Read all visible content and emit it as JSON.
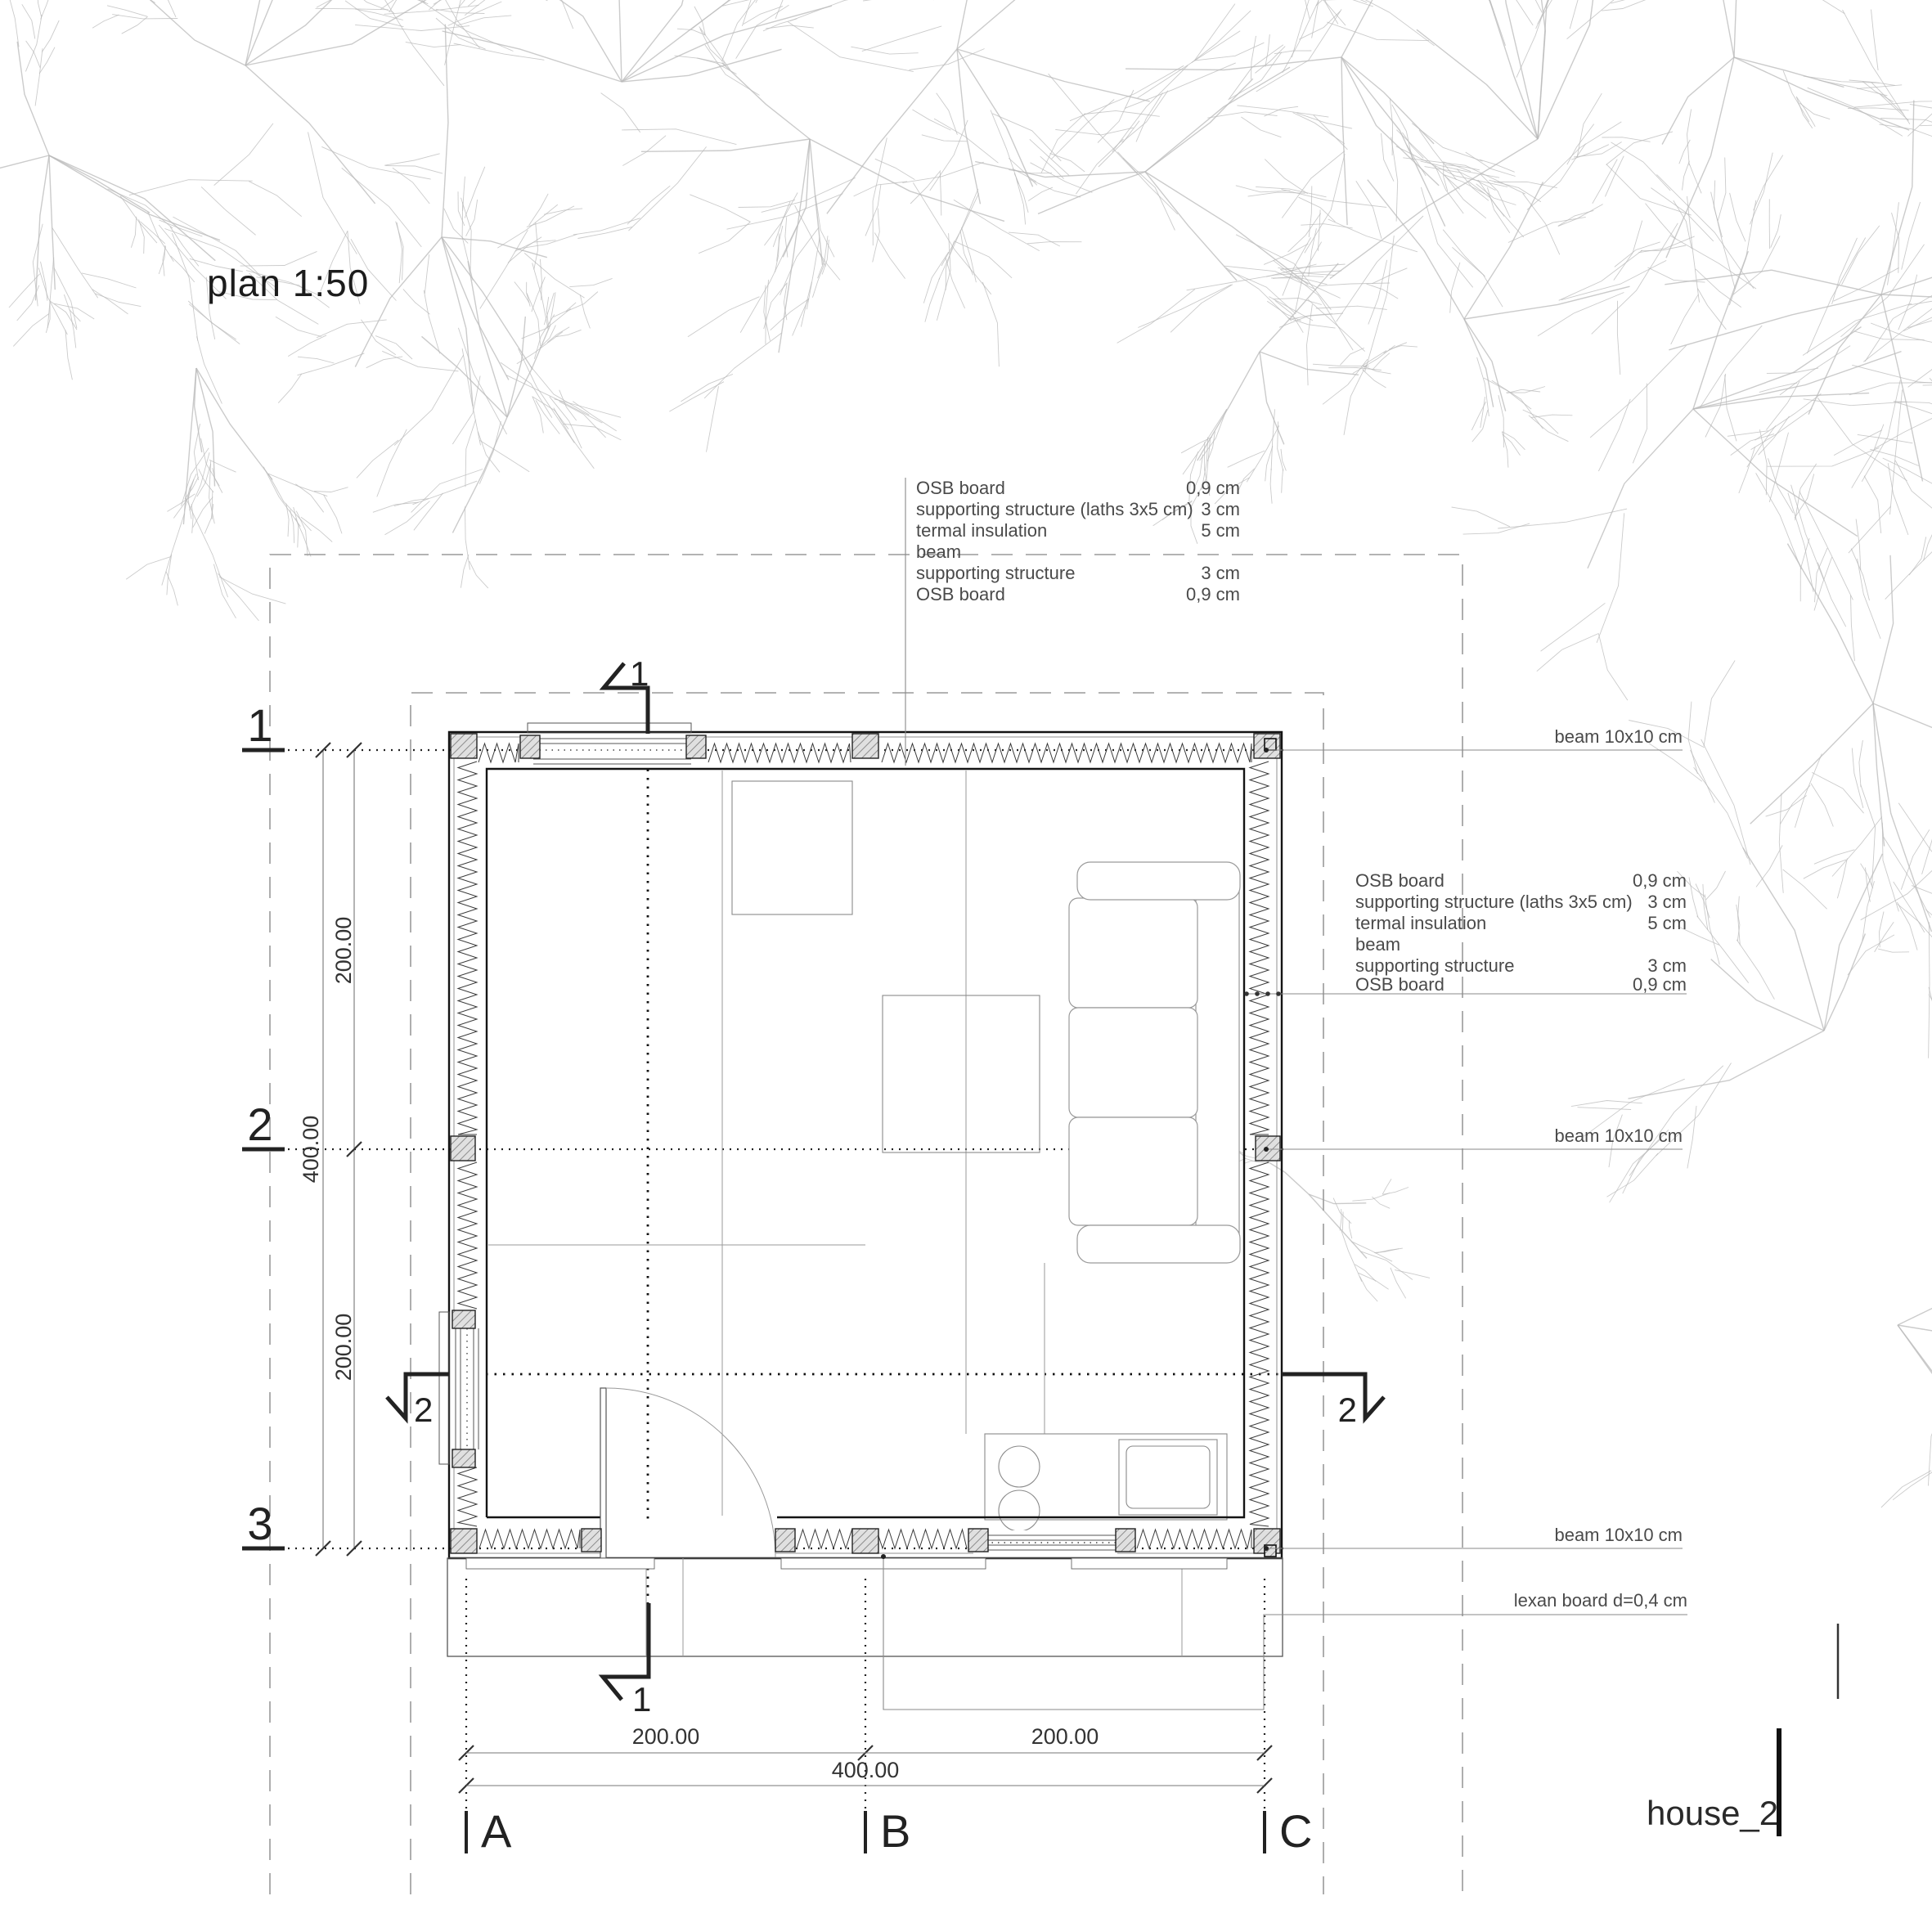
{
  "title": "plan 1:50",
  "sheet": {
    "label": "house_2"
  },
  "wall_layers_top": {
    "rows": [
      {
        "label": "OSB board",
        "value": "0,9 cm"
      },
      {
        "label": "supporting structure  (laths 3x5 cm)",
        "value": "3 cm"
      },
      {
        "label": "termal insulation",
        "value": "5 cm"
      },
      {
        "label": "beam",
        "value": ""
      },
      {
        "label": "supporting structure",
        "value": "3 cm"
      },
      {
        "label": "OSB board",
        "value": "0,9 cm"
      }
    ]
  },
  "wall_layers_right": {
    "rows": [
      {
        "label": "OSB board",
        "value": "0,9 cm"
      },
      {
        "label": "supporting structure  (laths 3x5 cm)",
        "value": "3 cm"
      },
      {
        "label": "termal insulation",
        "value": "5 cm"
      },
      {
        "label": "beam",
        "value": ""
      },
      {
        "label": "supporting structure",
        "value": "3 cm"
      },
      {
        "label": "OSB board",
        "value": "0,9 cm"
      }
    ]
  },
  "callouts": {
    "beam_top": "beam  10x10 cm",
    "beam_mid": "beam 10x10 cm",
    "beam_bottom": "beam 10x10 cm",
    "lexan": "lexan board d=0,4 cm"
  },
  "grid": {
    "row_labels": [
      "1",
      "2",
      "3"
    ],
    "col_labels": [
      "A",
      "B",
      "C"
    ],
    "section_1": "1",
    "section_2": "2"
  },
  "dims": {
    "left": {
      "seg1": "200.00",
      "seg2": "200.00",
      "total": "400.00"
    },
    "bottom": {
      "seg1": "200.00",
      "seg2": "200.00",
      "total": "400.00"
    }
  },
  "colors": {
    "ink": "#1a1a1a",
    "annotation": "#4a4a4a",
    "leader": "#8a8a8a",
    "dashed": "#9a9a9a",
    "branch": "#b9b9b9"
  }
}
